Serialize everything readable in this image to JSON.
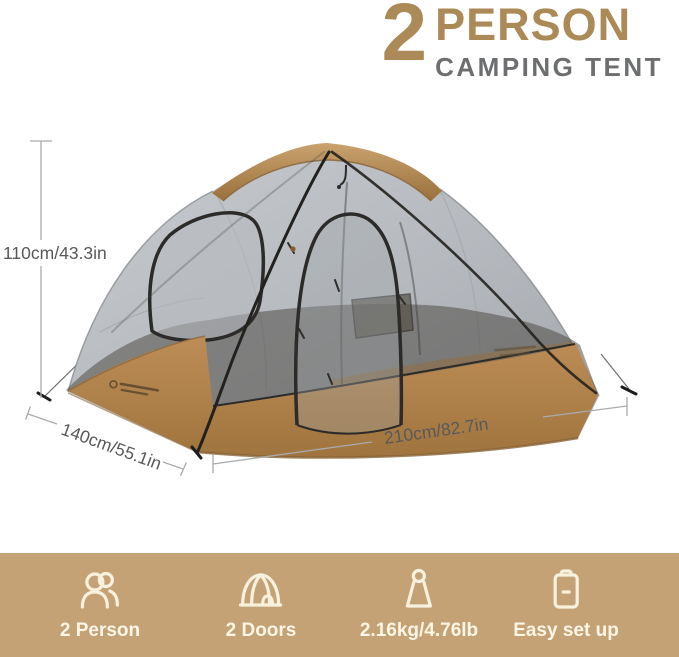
{
  "header": {
    "count": "2",
    "title": "PERSON",
    "subtitle": "CAMPING TENT"
  },
  "dimensions": {
    "height": "110cm/43.3in",
    "depth": "140cm/55.1in",
    "width": "210cm/82.7in"
  },
  "features": [
    {
      "icon": "two-person-icon",
      "label": "2 Person"
    },
    {
      "icon": "dome-tent-icon",
      "label": "2 Doors"
    },
    {
      "icon": "weight-icon",
      "label": "2.16kg/4.76lb"
    },
    {
      "icon": "clipboard-icon",
      "label": "Easy set up"
    }
  ],
  "colors": {
    "accent_tan": "#ab8a57",
    "subtitle_gray": "#6d6e70",
    "dimension_gray": "#58595b",
    "band_background": "#c4a275",
    "icon_cream": "#f8f1de",
    "tent_canvas_tan": "#b2834e",
    "tent_cap_brown": "#a87c48",
    "tent_mesh_gray": "#b8babd"
  }
}
